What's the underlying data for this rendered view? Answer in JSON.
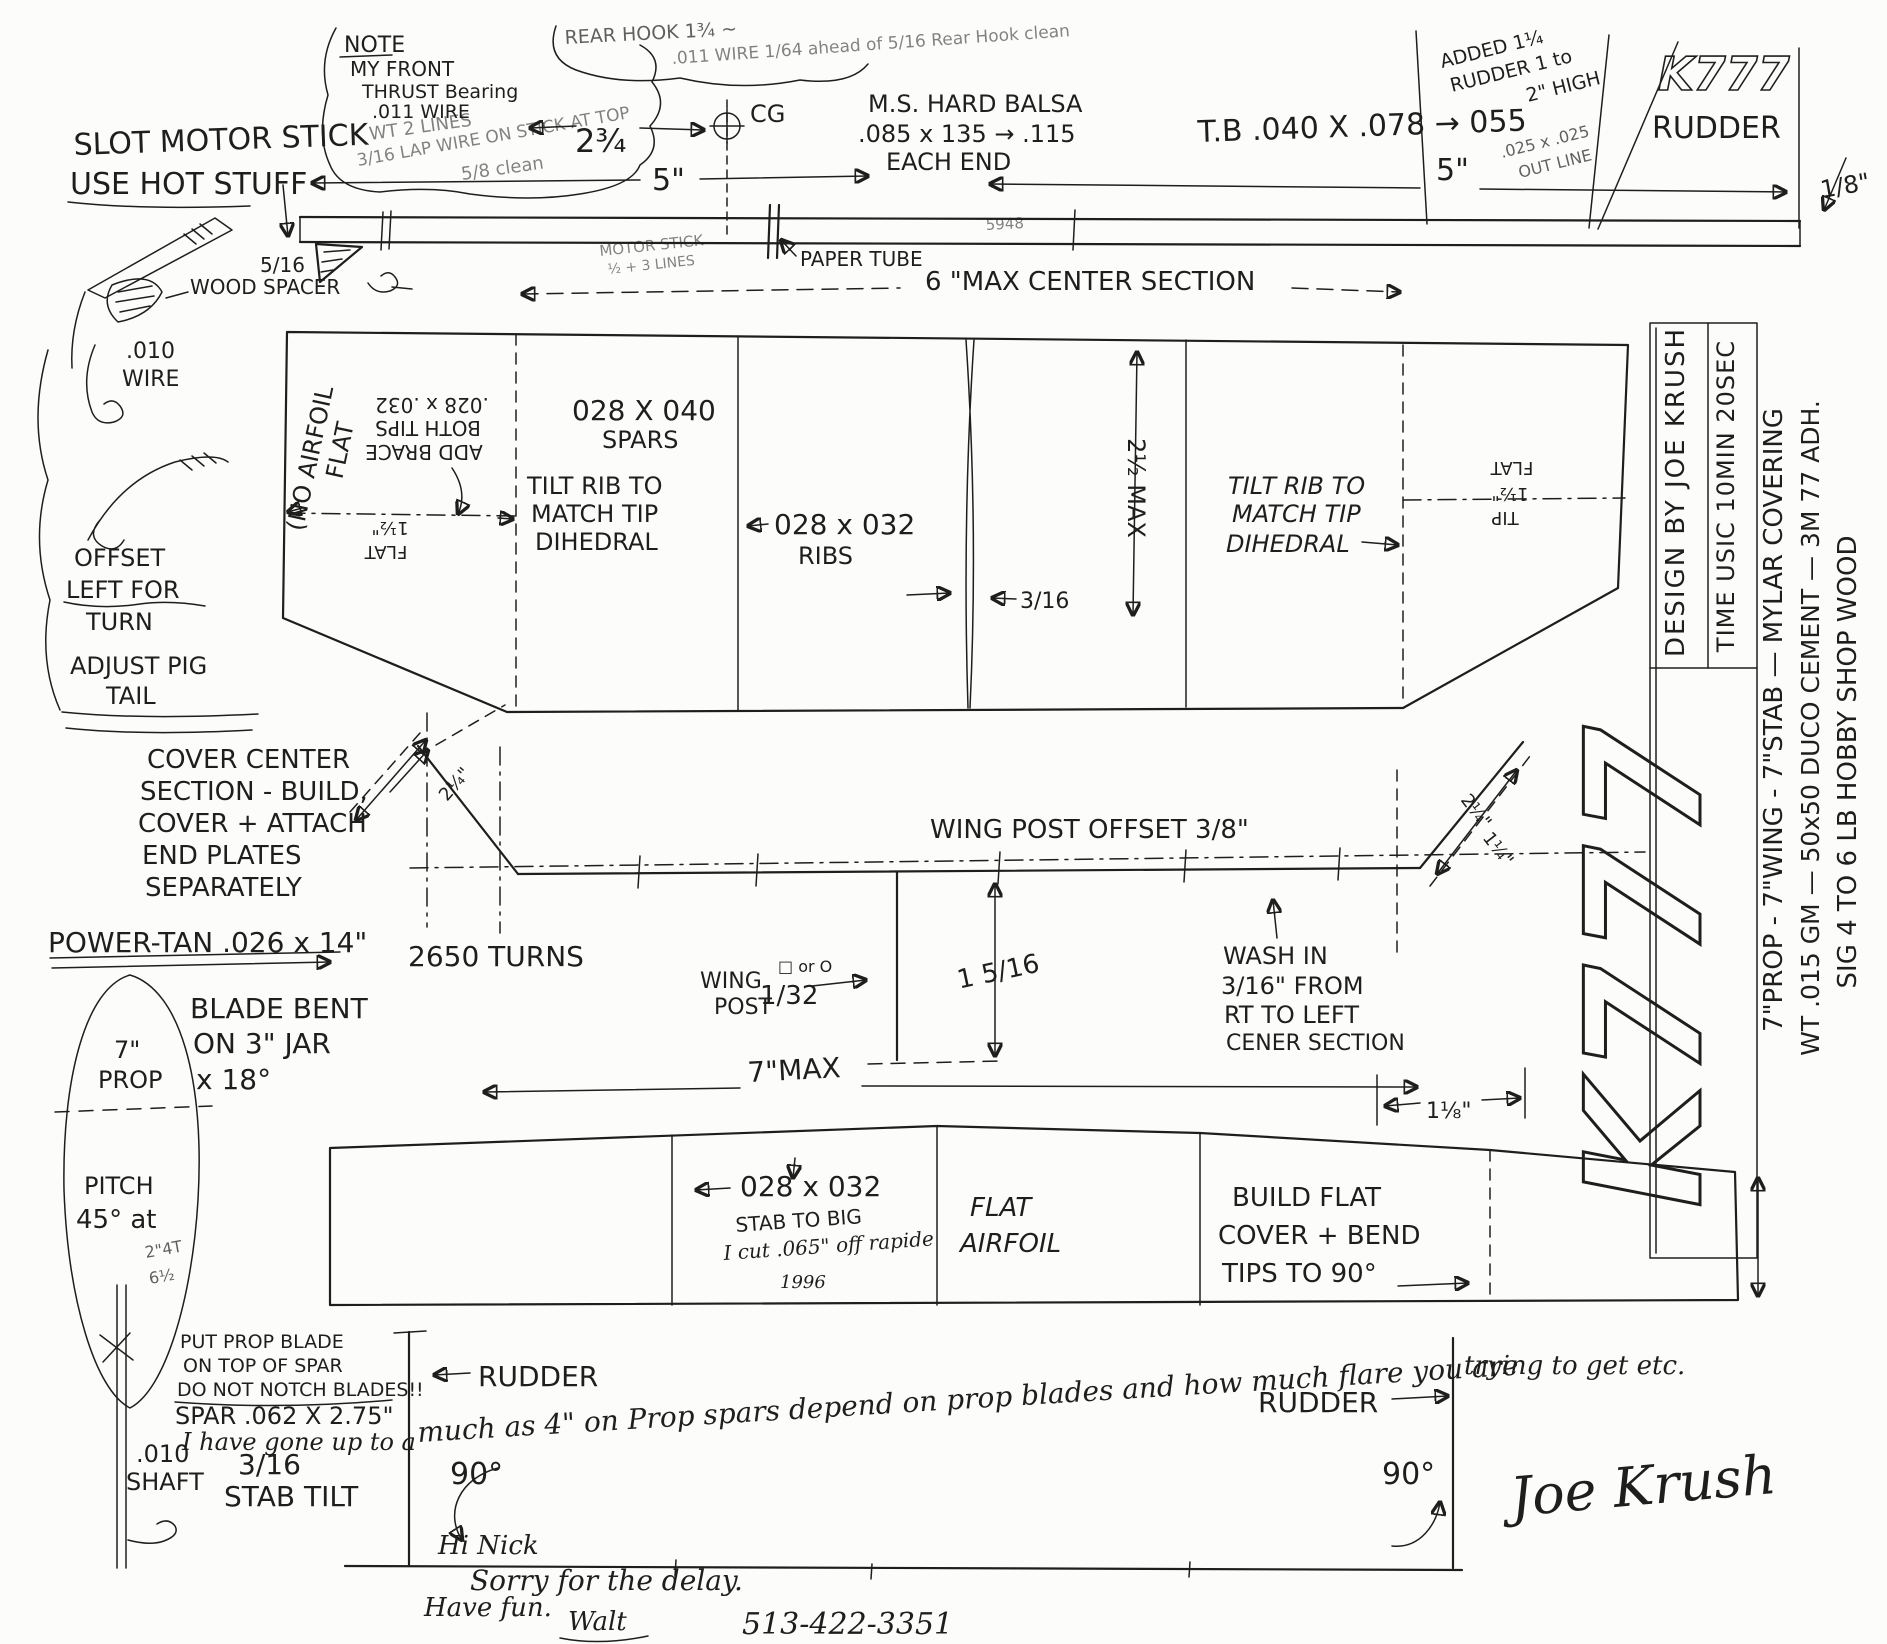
{
  "top_note": {
    "l1": "NOTE",
    "l2": "MY FRONT",
    "l3": "THRUST Bearing",
    "l4": ".011 WIRE",
    "l5": "WT 2 LINES",
    "l6": "3/16 LAP WIRE ON STICK AT TOP",
    "l7": "5/8 clean"
  },
  "rear_note": {
    "l1": "REAR HOOK 1¾ ~",
    "l2": ".011 WIRE 1/64 ahead of 5/16 Rear Hook clean"
  },
  "slot": {
    "l1": "SLOT MOTOR STICK",
    "l2": "USE HOT STUFF"
  },
  "stick": {
    "dim_left": "5\"",
    "dim_right": "5\"",
    "cg": "CG",
    "twothree": "2¾",
    "balsa1": "M.S. HARD BALSA",
    "balsa2": ".085 x 135 → .115",
    "balsa3": "EACH END",
    "tb": "T.B .040 X .078 → 055",
    "added1": "ADDED 1¼",
    "added2": "RUDDER 1 to",
    "added3": "2\" HIGH",
    "outline1": ".025 x .025",
    "outline2": "OUT LINE",
    "k777": "K777",
    "rudder": "RUDDER",
    "eighth": "1/8\"",
    "clearance": "5/16",
    "motor1": "MOTOR STICK",
    "motor2": "½ + 3 LINES",
    "paper": "PAPER TUBE",
    "mark": "5948"
  },
  "left_col": {
    "spacer": "WOOD SPACER",
    "wire1": ".010",
    "wire2": "WIRE",
    "offset1": "OFFSET",
    "offset2": "LEFT FOR",
    "offset3": "TURN",
    "adjust1": "ADJUST PIG",
    "adjust2": "TAIL"
  },
  "wing": {
    "maxcenter": "6 \"MAX CENTER SECTION",
    "noairfoil": "(NO AIRFOIL",
    "flat": "FLAT",
    "addbrace1": "ADD BRACE",
    "addbrace2": "BOTH TIPS",
    "addbrace3": ".028 x .032",
    "tipflat1": "1½\"",
    "tipflat2": "FLAT",
    "spars1": "028 X 040",
    "spars2": "SPARS",
    "tilt1": "TILT RIB TO",
    "tilt2": "MATCH TIP",
    "tilt3": "DIHEDRAL",
    "ribs1": "028 x 032",
    "ribs2": "RIBS",
    "ribdim": "3/16",
    "chord": "2½ MAX",
    "tiltr1": "TILT RIB TO",
    "tiltr2": "MATCH TIP",
    "tiltr3": "DIHEDRAL",
    "rtip1": "FLAT",
    "rtip2": "1½\"",
    "rtip3": "TIP",
    "brace_l": "2¼\"",
    "brace_r1": "2¼\"",
    "brace_r2": "1¼\""
  },
  "cover": {
    "l1": "COVER CENTER",
    "l2": "SECTION - BUILD,",
    "l3": "COVER + ATTACH",
    "l4": "END PLATES",
    "l5": "SEPARATELY"
  },
  "front": {
    "offset": "WING POST OFFSET 3/8\"",
    "wing": "WING",
    "post": "POST",
    "fraction": "1/32",
    "square": "□ or O",
    "height": "1 5/16",
    "wash1": "WASH IN",
    "wash2": "3/16\" FROM",
    "wash3": "RT TO LEFT",
    "wash4": "CENER SECTION",
    "span": "7\"MAX",
    "gap": "1⅛\""
  },
  "power": {
    "l1": "POWER-TAN .026 x 14\"",
    "l2": "2650 TURNS"
  },
  "prop": {
    "blade1": "BLADE BENT",
    "blade2": "ON 3\" JAR",
    "blade3": "x 18°",
    "size": "7\"",
    "label": "PROP",
    "pitch1": "PITCH",
    "pitch2": "45° at",
    "pitch3": "2\"4T",
    "pitch4": "6½",
    "shaft1": ".010",
    "shaft2": "SHAFT",
    "tilt_frac": "3/16",
    "tilt": "STAB TILT",
    "note1": "PUT PROP BLADE",
    "note2": "ON TOP OF SPAR",
    "note3": "DO NOT NOTCH BLADES!!",
    "note4": "SPAR .062 X 2.75\"",
    "note5": "I have gone up to a"
  },
  "stab": {
    "size": "028 x 032",
    "big1": "STAB TO BIG",
    "big2": "I cut .065\" off rapide",
    "big3": "1996",
    "flat1": "FLAT",
    "flat2": "AIRFOIL",
    "build1": "BUILD FLAT",
    "build2": "COVER + BEND",
    "build3": "TIPS TO 90°"
  },
  "rudder_view": {
    "left": "RUDDER",
    "right": "RUDDER",
    "deg_l": "90°",
    "deg_r": "90°",
    "note": "much as 4\" on Prop spars depend on prop blades and how much flare you are",
    "note2": "trying to get etc.",
    "signature": "Joe Krush"
  },
  "footer": {
    "l1": "Hi Nick",
    "l2": "Sorry for the delay.",
    "l3": "Have fun.",
    "l4": "Walt",
    "phone": "513-422-3351"
  },
  "sidebar": {
    "design": "DESIGN BY JOE KRUSH",
    "time": "TIME USIC 10MIN 20SEC",
    "k777": "K777",
    "spec1": "7\"PROP - 7\"WING - 7\"STAB — MYLAR COVERING",
    "spec2": "WT .015 GM — 50x50 DUCO CEMENT — 3M 77 ADH.",
    "spec3": "SIG 4 TO 6 LB HOBBY SHOP WOOD"
  }
}
